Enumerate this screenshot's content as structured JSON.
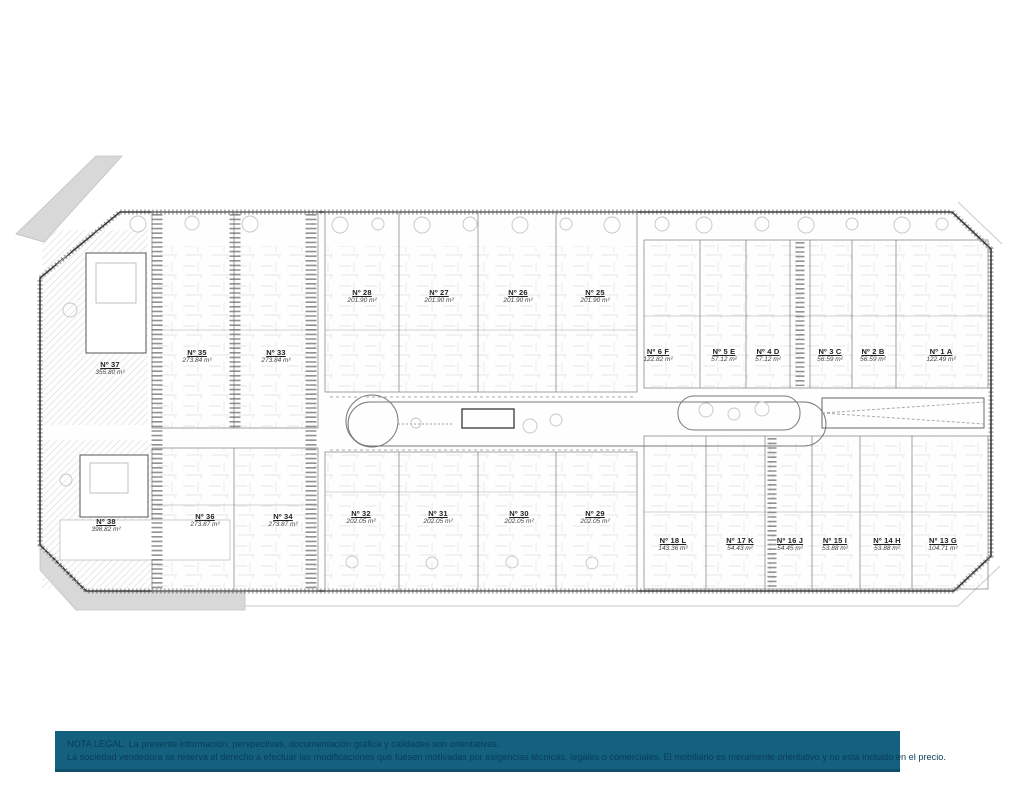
{
  "colors": {
    "legal_bar_bg": "#13607F",
    "legal_text": "#0A3C59",
    "plan_line": "#444444",
    "road_gray": "#D8D8D8",
    "page_bg": "#FFFFFF"
  },
  "plan": {
    "units": [
      {
        "number": "Nº 37",
        "area": "355.80 m²"
      },
      {
        "number": "Nº 35",
        "area": "273.84 m²"
      },
      {
        "number": "Nº 33",
        "area": "273.84 m²"
      },
      {
        "number": "Nº 28",
        "area": "201.90 m²"
      },
      {
        "number": "Nº 27",
        "area": "201.90 m²"
      },
      {
        "number": "Nº 26",
        "area": "201.90 m²"
      },
      {
        "number": "Nº 25",
        "area": "201.90 m²"
      },
      {
        "number": "Nº 6 F",
        "area": "122.82 m²"
      },
      {
        "number": "Nº 5 E",
        "area": "57.12 m²"
      },
      {
        "number": "Nº 4 D",
        "area": "57.12 m²"
      },
      {
        "number": "Nº 3 C",
        "area": "56.59 m²"
      },
      {
        "number": "Nº 2 B",
        "area": "56.59 m²"
      },
      {
        "number": "Nº 1 A",
        "area": "122.49 m²"
      },
      {
        "number": "Nº 38",
        "area": "398.82 m²"
      },
      {
        "number": "Nº 36",
        "area": "273.87 m²"
      },
      {
        "number": "Nº 34",
        "area": "273.87 m²"
      },
      {
        "number": "Nº 32",
        "area": "202.05 m²"
      },
      {
        "number": "Nº 31",
        "area": "202.05 m²"
      },
      {
        "number": "Nº 30",
        "area": "202.05 m²"
      },
      {
        "number": "Nº 29",
        "area": "202.05 m²"
      },
      {
        "number": "Nº 18 L",
        "area": "143.36 m²"
      },
      {
        "number": "Nº 17 K",
        "area": "54.43 m²"
      },
      {
        "number": "Nº 16 J",
        "area": "54.45 m²"
      },
      {
        "number": "Nº 15 I",
        "area": "53.88 m²"
      },
      {
        "number": "Nº 14 H",
        "area": "53.88 m²"
      },
      {
        "number": "Nº 13 G",
        "area": "104.71 m²"
      }
    ]
  },
  "legal": {
    "line1": "NOTA LEGAL: La presente información, perspectivas, documentación gráfica y calidades son orientativas.",
    "line2": "La sociedad vendedora se reserva el derecho a efectuar las modificaciones que fuesen motivadas por exigencias técnicas, legales o comerciales. El mobiliario es meramente orientativo y no está incluido en el precio."
  }
}
